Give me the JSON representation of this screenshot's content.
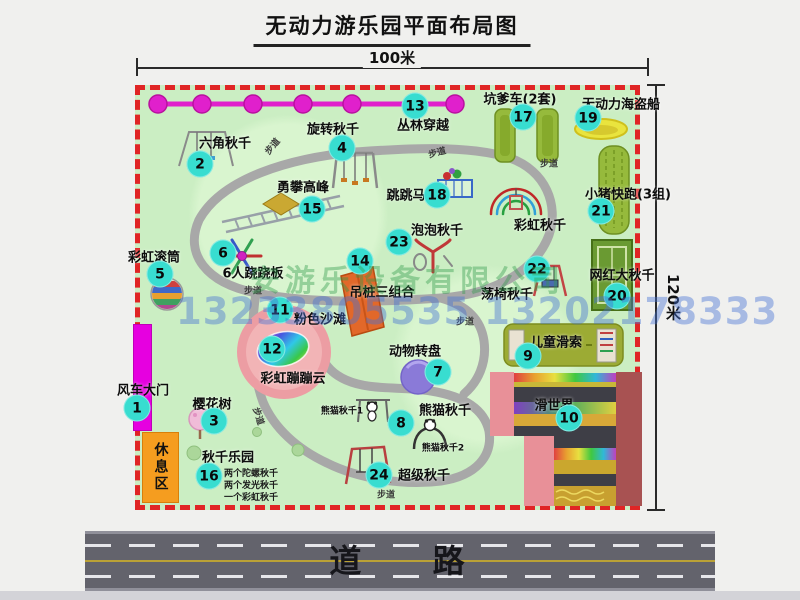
{
  "title": "无动力游乐园平面布局图",
  "dimensions": {
    "width_label": "100米",
    "height_label": "120米"
  },
  "road": {
    "label": "道 路"
  },
  "watermark": {
    "company": "安游乐设备有限公司",
    "phone": "13233805535 13202178333"
  },
  "colors": {
    "map_bg": "#cbeec3",
    "border_red": "#e02525",
    "badge_cyan": "#38ddd0",
    "zipline_pink": "#e020cc",
    "road_gray": "#63636c",
    "gate_magenta": "#e600e0",
    "rest_area_orange": "#f59d1f",
    "beach_pink": "#ec9da3",
    "footpath_gray": "#a8a8a8"
  },
  "map": {
    "rest_area_label": "休息区",
    "footpath_label": "步道",
    "attractions": [
      {
        "n": 1,
        "label": "风车大门",
        "bx": 137,
        "by": 408,
        "lx": 143,
        "ly": 389
      },
      {
        "n": 2,
        "label": "六角秋千",
        "bx": 200,
        "by": 164,
        "lx": 225,
        "ly": 142
      },
      {
        "n": 3,
        "label": "樱花树",
        "bx": 214,
        "by": 421,
        "lx": 212,
        "ly": 403
      },
      {
        "n": 4,
        "label": "旋转秋千",
        "bx": 342,
        "by": 148,
        "lx": 333,
        "ly": 128
      },
      {
        "n": 5,
        "label": "彩虹滚筒",
        "bx": 160,
        "by": 274,
        "lx": 154,
        "ly": 256
      },
      {
        "n": 6,
        "label": "6人跷跷板",
        "bx": 223,
        "by": 253,
        "lx": 253,
        "ly": 272
      },
      {
        "n": 7,
        "label": "动物转盘",
        "bx": 438,
        "by": 372,
        "lx": 415,
        "ly": 350
      },
      {
        "n": 8,
        "label": "熊猫秋千",
        "bx": 401,
        "by": 423,
        "lx": 445,
        "ly": 409
      },
      {
        "n": 9,
        "label": "儿童滑索",
        "bx": 528,
        "by": 356,
        "lx": 556,
        "ly": 341
      },
      {
        "n": 10,
        "label": "滑世界",
        "bx": 569,
        "by": 418,
        "lx": 554,
        "ly": 404
      },
      {
        "n": 11,
        "label": "粉色沙滩",
        "bx": 280,
        "by": 310,
        "lx": 320,
        "ly": 318
      },
      {
        "n": 12,
        "label": "彩虹蹦蹦云",
        "bx": 272,
        "by": 349,
        "lx": 293,
        "ly": 377
      },
      {
        "n": 13,
        "label": "丛林穿越",
        "bx": 415,
        "by": 106,
        "lx": 423,
        "ly": 124
      },
      {
        "n": 14,
        "label": "吊桩三组合",
        "bx": 360,
        "by": 261,
        "lx": 382,
        "ly": 291
      },
      {
        "n": 15,
        "label": "勇攀高峰",
        "bx": 312,
        "by": 209,
        "lx": 303,
        "ly": 186
      },
      {
        "n": 16,
        "label": "秋千乐园",
        "bx": 209,
        "by": 476,
        "lx": 228,
        "ly": 456
      },
      {
        "n": 17,
        "label": "坑爹车(2套)",
        "bx": 523,
        "by": 117,
        "lx": 520,
        "ly": 98
      },
      {
        "n": 18,
        "label": "跳跳马",
        "bx": 437,
        "by": 195,
        "lx": 406,
        "ly": 194
      },
      {
        "n": 19,
        "label": "无动力海盗船",
        "bx": 588,
        "by": 118,
        "lx": 621,
        "ly": 103
      },
      {
        "n": 20,
        "label": "网红大秋千",
        "bx": 617,
        "by": 296,
        "lx": 622,
        "ly": 274
      },
      {
        "n": 21,
        "label": "小猪快跑(3组)",
        "bx": 601,
        "by": 211,
        "lx": 628,
        "ly": 193
      },
      {
        "n": 22,
        "label": "荡椅秋千",
        "bx": 537,
        "by": 269,
        "lx": 507,
        "ly": 293
      },
      {
        "n": 23,
        "label": "泡泡秋千",
        "bx": 399,
        "by": 242,
        "lx": 437,
        "ly": 229
      },
      {
        "n": 24,
        "label": "超级秋千",
        "bx": 379,
        "by": 475,
        "lx": 424,
        "ly": 474
      },
      {
        "n": null,
        "label": "彩虹秋千",
        "bx": null,
        "by": null,
        "lx": 540,
        "ly": 224
      }
    ],
    "extra_labels": [
      {
        "text": "熊猫秋千1",
        "x": 342,
        "y": 410
      },
      {
        "text": "熊猫秋千2",
        "x": 443,
        "y": 447
      }
    ],
    "swing_park_notes": {
      "x": 224,
      "y": 466,
      "lines": [
        "两个陀螺秋千",
        "两个发光秋千",
        "一个彩虹秋千"
      ]
    },
    "path_markers": [
      {
        "x": 272,
        "y": 146,
        "r": -50
      },
      {
        "x": 437,
        "y": 152,
        "r": -15
      },
      {
        "x": 549,
        "y": 163,
        "r": 0
      },
      {
        "x": 253,
        "y": 290,
        "r": 0
      },
      {
        "x": 465,
        "y": 321,
        "r": 0
      },
      {
        "x": 259,
        "y": 416,
        "r": 72
      },
      {
        "x": 386,
        "y": 494,
        "r": 0
      }
    ]
  }
}
